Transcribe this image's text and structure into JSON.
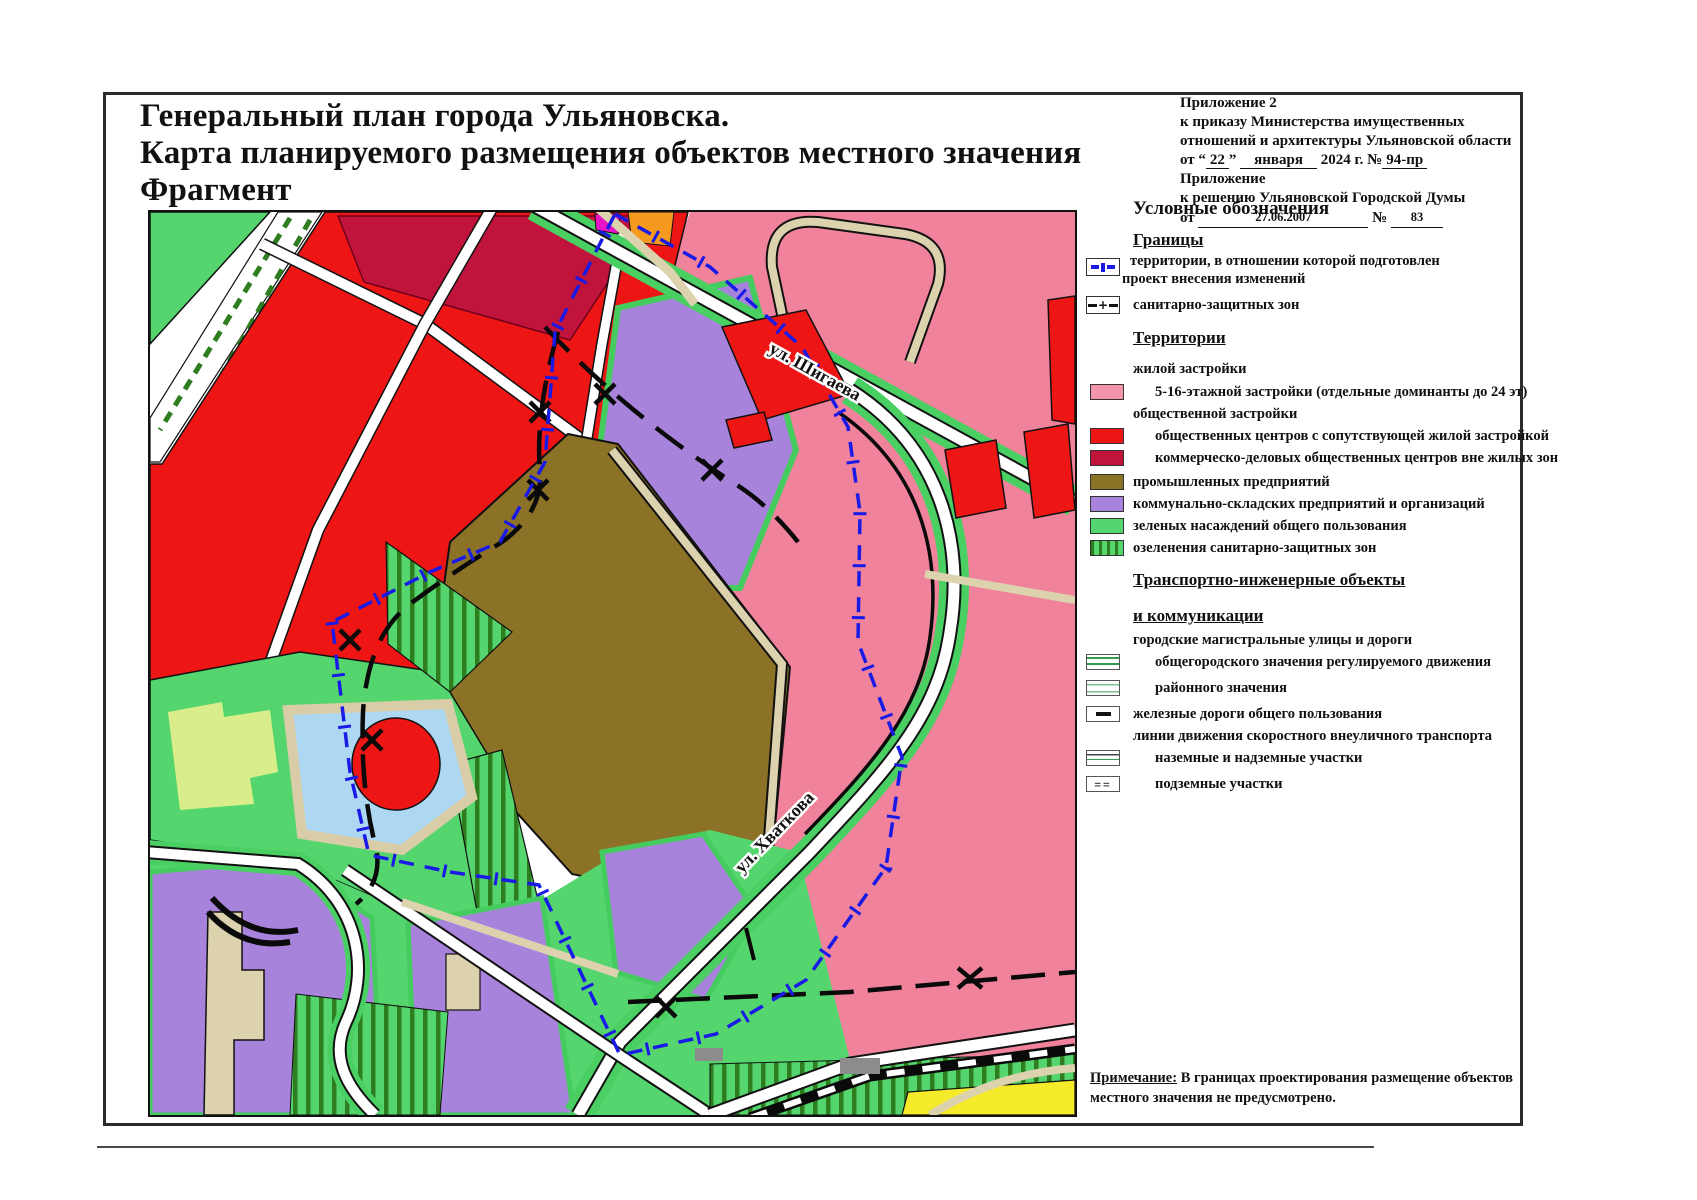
{
  "title": {
    "line1": "Генеральный план города Ульяновска.",
    "line2": "Карта планируемого размещения объектов местного значения",
    "line3": "Фрагмент"
  },
  "appendix": {
    "l1": "Приложение  2",
    "l2": "к приказу Министерства имущественных",
    "l3": "отношений и архитектуры Ульяновской области",
    "l4_p1": "от “",
    "l4_day": "22",
    "l4_p2": "”",
    "l4_month": "января",
    "l4_p3": "2024 г. №",
    "l4_num": "94-пр",
    "l5": "Приложение",
    "l6": "к решению Ульяновской Городской Думы",
    "l7_p1": "от",
    "l7_date": "27.06.2007",
    "l7_p2": "№",
    "l7_num": "83"
  },
  "legend": {
    "header": "Условные обозначения",
    "sec_borders": "Границы",
    "b_item1_l1": "территории, в отношении которой подготовлен",
    "b_item1_l2": "проект внесения изменений",
    "b_item2": "санитарно-защитных зон",
    "sec_terr": "Территории",
    "grp_residential": "жилой застройки",
    "t_pink": "5-16-этажной застройки (отдельные доминанты до 24 эт)",
    "grp_public": "общественной застройки",
    "t_red": "общественных центров с сопутствующей жилой застройкой",
    "t_crimson": "коммерческо-деловых общественных центров вне жилых зон",
    "t_olive": "промышленных предприятий",
    "t_purple": "коммунально-складских предприятий и организаций",
    "t_green": "зеленых насаждений общего пользования",
    "t_hatch": "озеленения санитарно-защитных зон",
    "sec_transport_l1": "Транспортно-инженерные объекты",
    "sec_transport_l2": "и коммуникации",
    "grp_streets": "городские магистральные улицы и дороги",
    "r_city": "общегородского значения регулируемого движения",
    "r_district": "районного значения",
    "r_rail": "железные дороги общего пользования",
    "grp_rapid": "линии движения скоростного внеуличного транспорта",
    "r_surface": "наземные и надземные участки",
    "r_underground": "подземные  участки"
  },
  "map": {
    "street1": "ул. Шигаева",
    "street2": "ул. Хваткова"
  },
  "note": {
    "label": "Примечание:",
    "text": " В границах проектирования размещение объектов местного значения не предусмотрено."
  },
  "colors": {
    "pink": "#F0829B",
    "red": "#EE1515",
    "crimson": "#C0143C",
    "industrial_olive": "#8B7226",
    "purple": "#A883DB",
    "green": "#55D56E",
    "hatch_stripe": "#2E7D1F",
    "road_tan": "#DCD2AE",
    "pond_blue": "#AED7F2",
    "yellow_green": "#D9EE8A",
    "yellow": "#F5EB2A",
    "magenta": "#E616C6",
    "orange": "#F5991F",
    "boundary_blue": "#1A1AE6"
  }
}
